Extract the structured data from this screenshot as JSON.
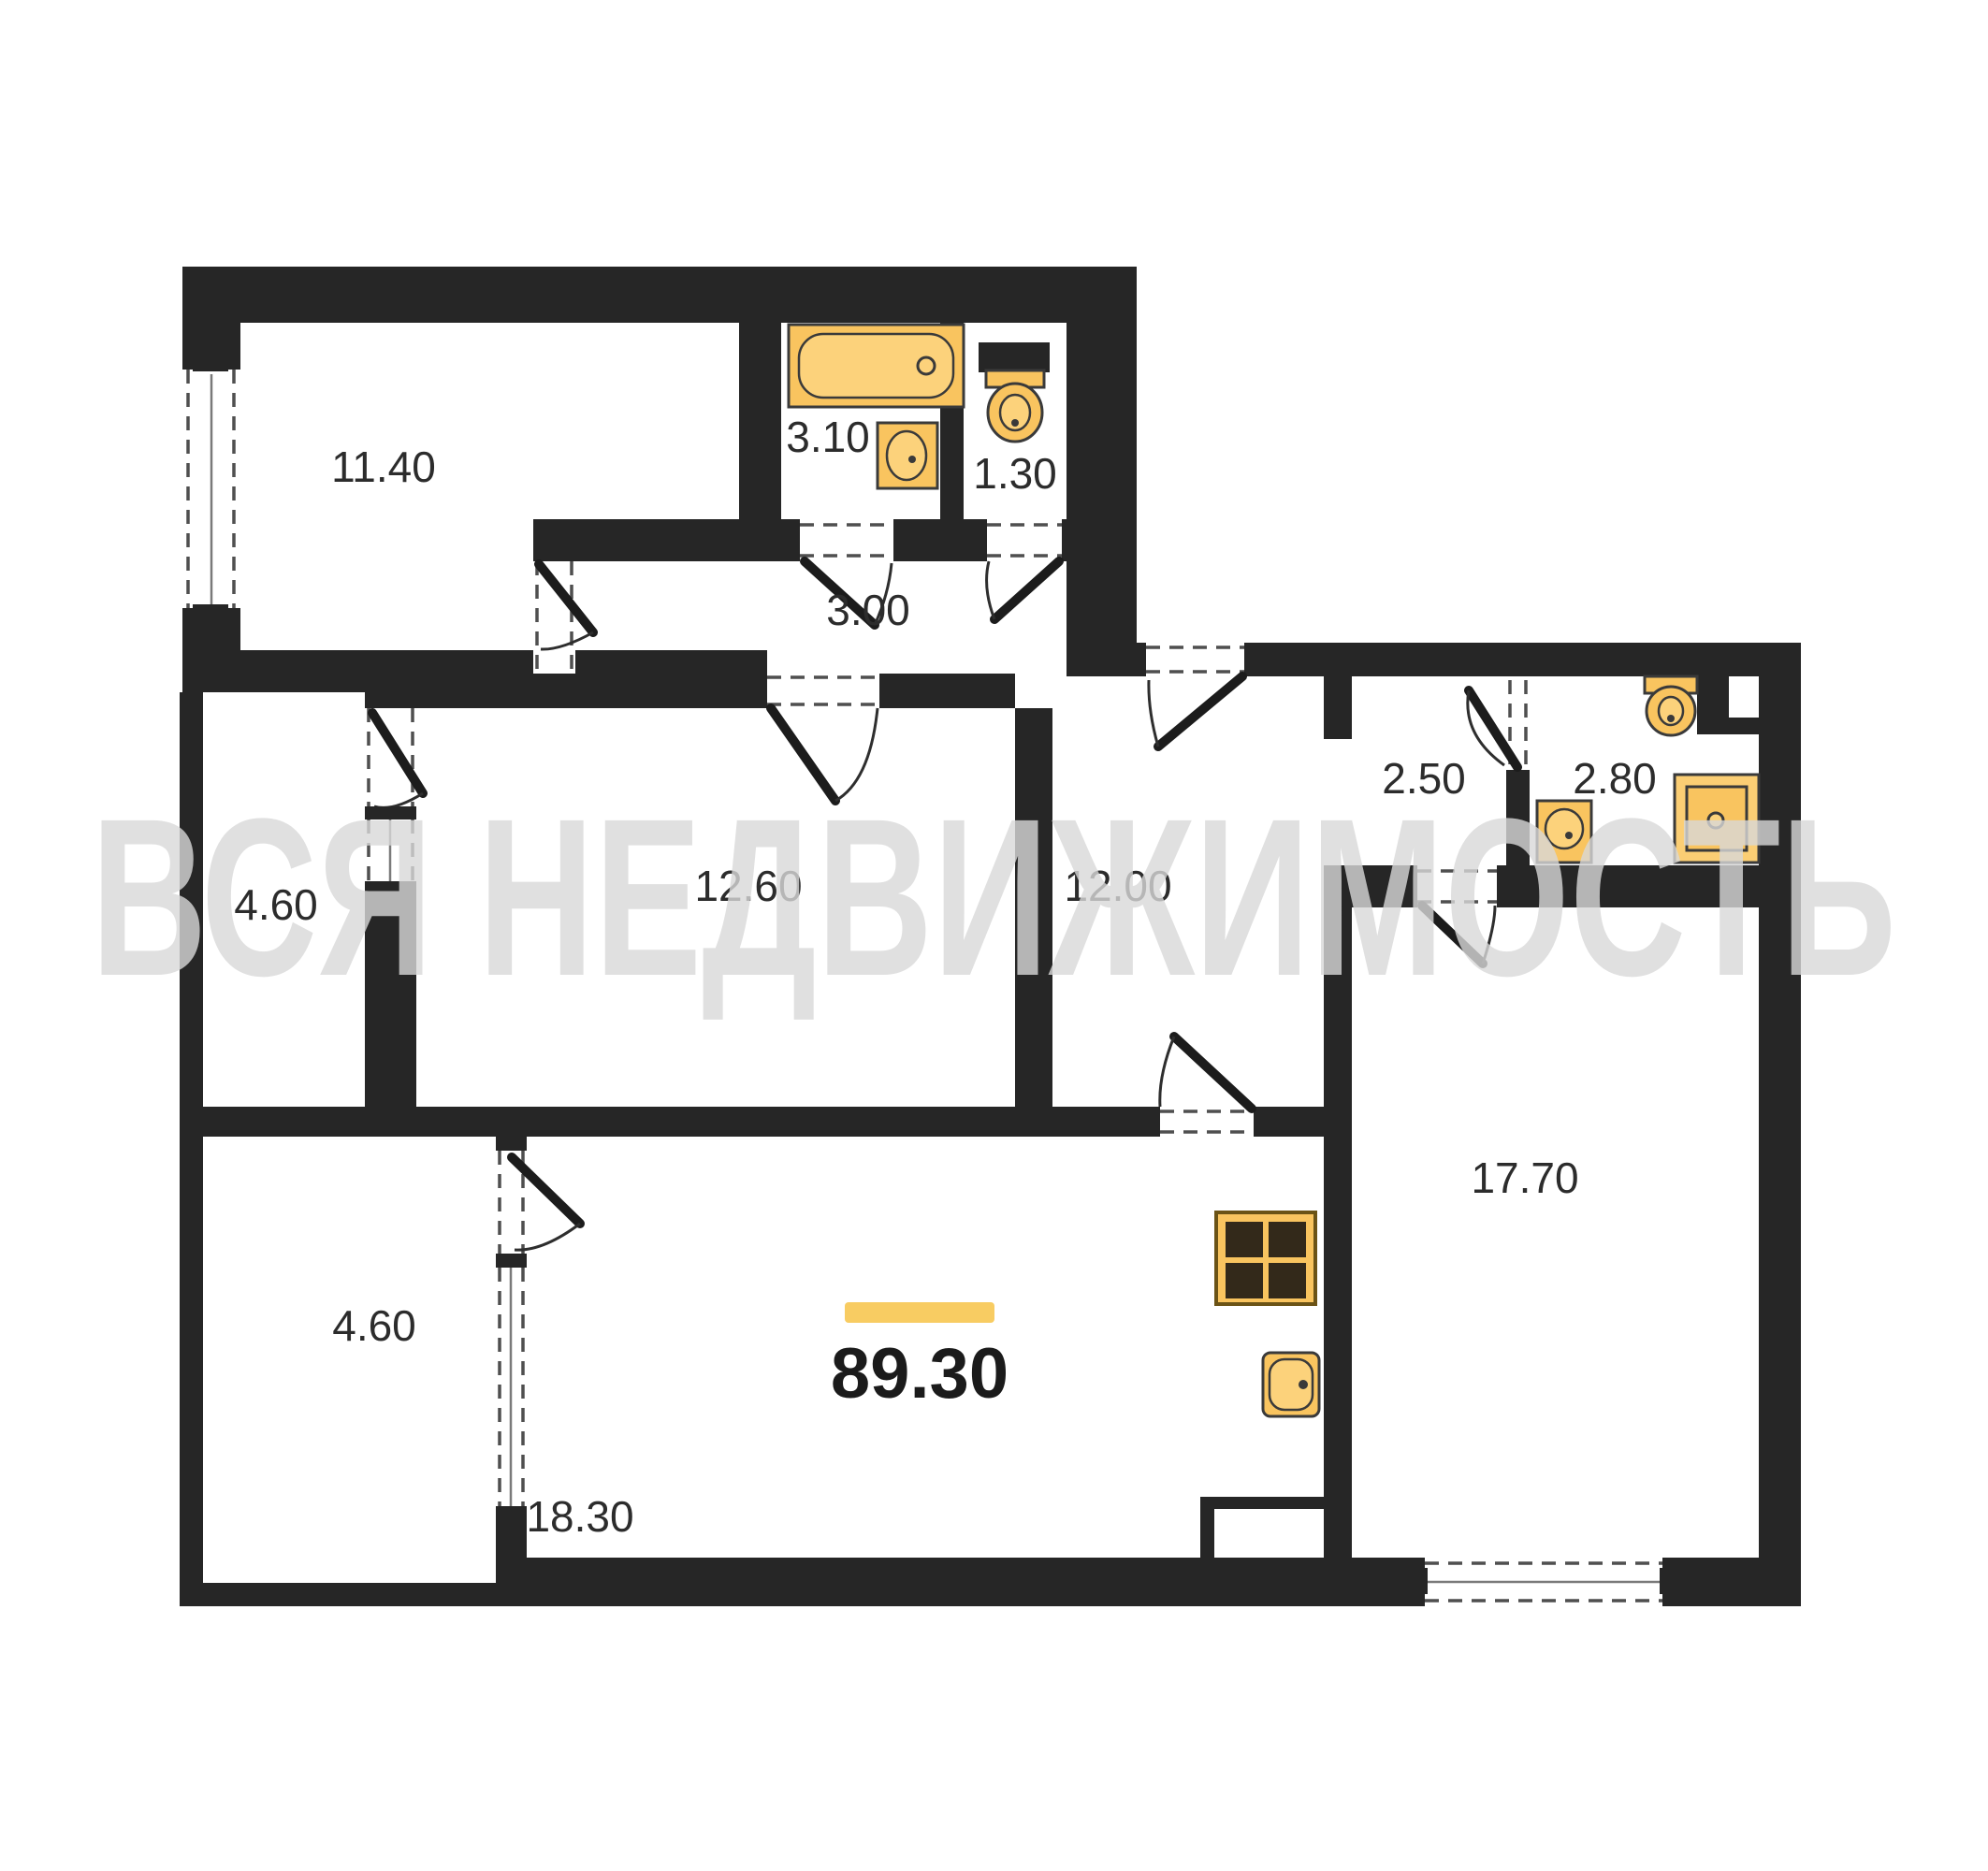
{
  "watermark": "ВСЯ НЕДВИЖИМОСТЬ",
  "total": {
    "area": "89.30",
    "marker_color": "#F8CC62"
  },
  "rooms": [
    {
      "name": "bedroom",
      "area": "11.40"
    },
    {
      "name": "bathroom",
      "area": "3.10"
    },
    {
      "name": "wc",
      "area": "1.30"
    },
    {
      "name": "inner-hall",
      "area": "3.00"
    },
    {
      "name": "loggia-upper",
      "area": "4.60"
    },
    {
      "name": "room-middle",
      "area": "12.60"
    },
    {
      "name": "corridor",
      "area": "12.00"
    },
    {
      "name": "hall-small",
      "area": "2.50"
    },
    {
      "name": "shower-room",
      "area": "2.80"
    },
    {
      "name": "living-room",
      "area": "17.70"
    },
    {
      "name": "loggia-lower",
      "area": "4.60"
    },
    {
      "name": "kitchen-living",
      "area": "18.30"
    }
  ],
  "fixtures": [
    "bathtub",
    "wash-basin",
    "toilet",
    "toilet",
    "wash-basin",
    "shower-tray",
    "stove",
    "kitchen-sink"
  ],
  "colors": {
    "wall": "#262626",
    "fixture": "#F9C45F",
    "fixture_light": "#FCD27B",
    "accent_bar": "#F8CC62",
    "watermark": "#d9d9d9",
    "label": "#2c2c2c"
  }
}
